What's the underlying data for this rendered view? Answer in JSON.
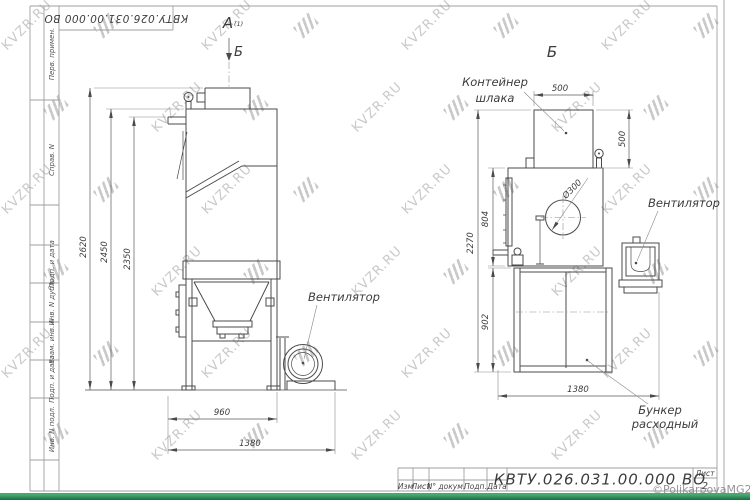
{
  "frame": {
    "top_stamp": "КВТУ.026.031.00.000  ВО",
    "left_fields": [
      "Перв. примен.",
      "Справ. N",
      "Подп. и дата",
      "Инв. N дубл.",
      "Взам. инв. N",
      "Подп. и дата",
      "Инв. N подл."
    ]
  },
  "view_a": {
    "label": "А",
    "label_index": "(1)",
    "direction_label": "Б",
    "fan_callout": "Вентилятор",
    "dim_2620": "2620",
    "dim_2450": "2450",
    "dim_2350": "2350",
    "dim_960": "960",
    "dim_1380": "1380"
  },
  "view_b": {
    "label": "Б",
    "container_callout_1": "Контейнер",
    "container_callout_2": "шлака",
    "fan_callout": "Вентилятор",
    "bunker_callout_1": "Бункер",
    "bunker_callout_2": "расходный",
    "dim_500_top": "500",
    "dim_500_right": "500",
    "dim_804": "804",
    "dim_2270": "2270",
    "dim_902": "902",
    "dim_1380": "1380",
    "dim_dia": "Ø300"
  },
  "title_block": {
    "col_labels": [
      "Изм",
      "Лист",
      "N° докум.",
      "Подп.",
      "Дата"
    ],
    "designation": "КВТУ.026.031.00.000  ВО",
    "sheet_label": "Лист",
    "sheet_number": "2"
  },
  "watermark": {
    "text": "KVZR.RU"
  },
  "copyright": "©PolikarpovaMG2021",
  "colors": {
    "bottom_bar": "#2f9a63",
    "watermark": "#c9c9c9",
    "lines": "#4b4b4b"
  }
}
